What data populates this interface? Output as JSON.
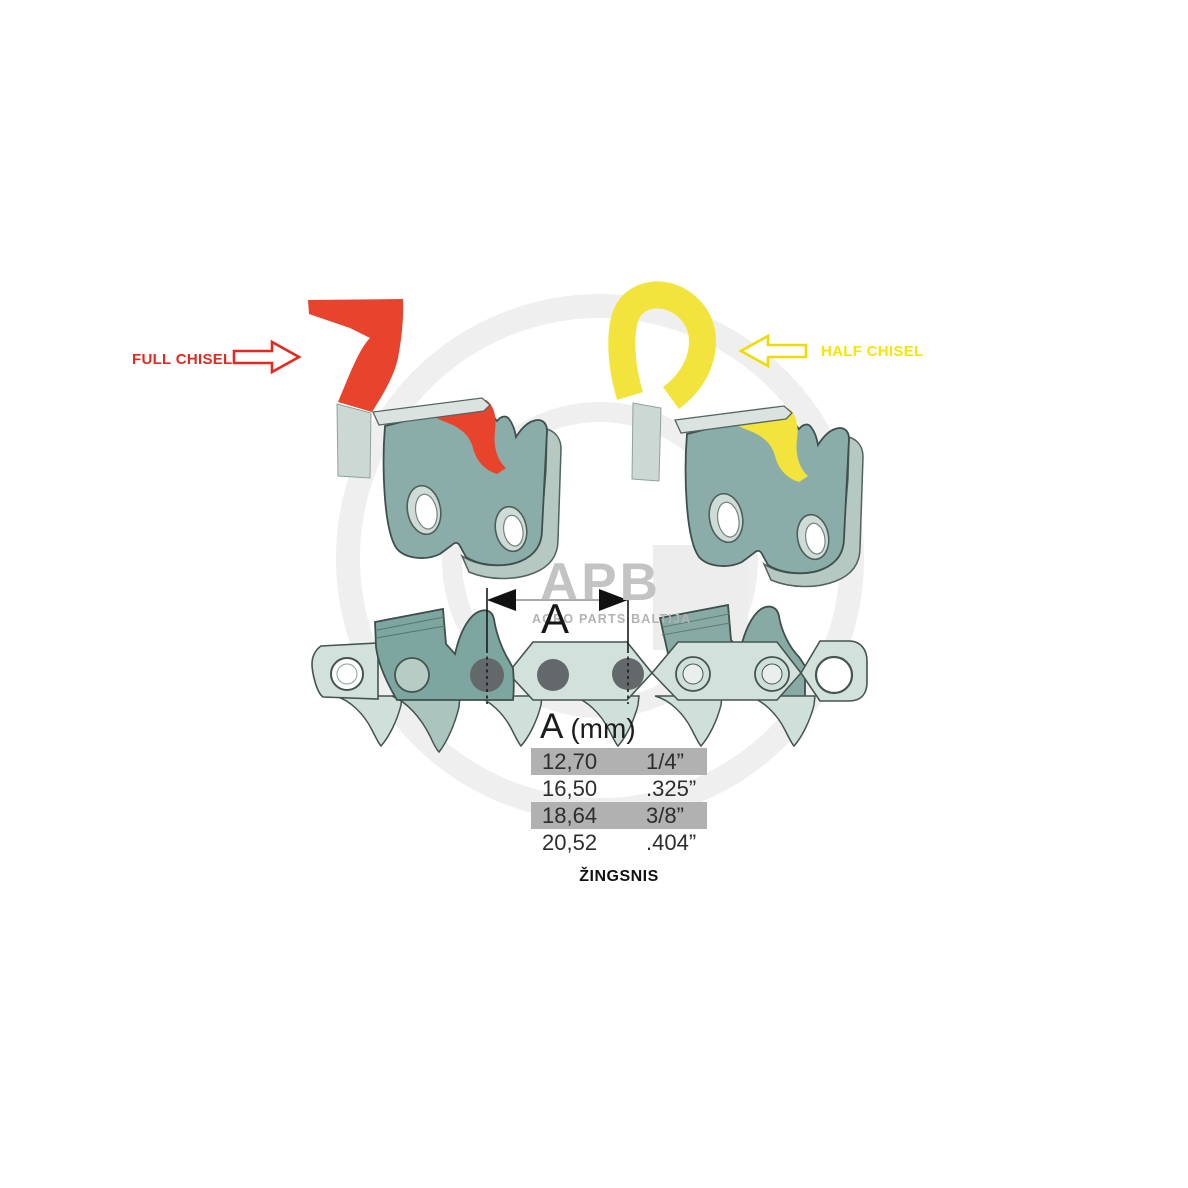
{
  "annotations": {
    "full_chisel_label": "FULL CHISEL",
    "half_chisel_label": "HALF CHISEL"
  },
  "watermark": {
    "logo_text": "APB",
    "tagline": "AGRO PARTS BALTIJA"
  },
  "dimension": {
    "label": "A"
  },
  "pitch_table": {
    "header_letter": "A",
    "header_unit": "(mm)",
    "caption": "ŽINGSNIS",
    "rows": [
      {
        "mm": "12,70",
        "inch": "1/4”",
        "highlighted": true
      },
      {
        "mm": "16,50",
        "inch": ".325”",
        "highlighted": false
      },
      {
        "mm": "18,64",
        "inch": "3/8”",
        "highlighted": true
      },
      {
        "mm": "20,52",
        "inch": ".404”",
        "highlighted": false
      }
    ]
  },
  "colors": {
    "full_chisel_red": "#e8432c",
    "half_chisel_yellow": "#f2e43c",
    "red_label_text": "#e8281f",
    "yellow_label_text": "#f8e405",
    "link_face_teal": "#8badaa",
    "strap_teal": "#d2e1db",
    "cutter_dark_teal": "#7da6a0",
    "rivet_gray": "#63686a",
    "table_highlight_gray": "#b1b1b1",
    "watermark_gray": "#ededed"
  }
}
